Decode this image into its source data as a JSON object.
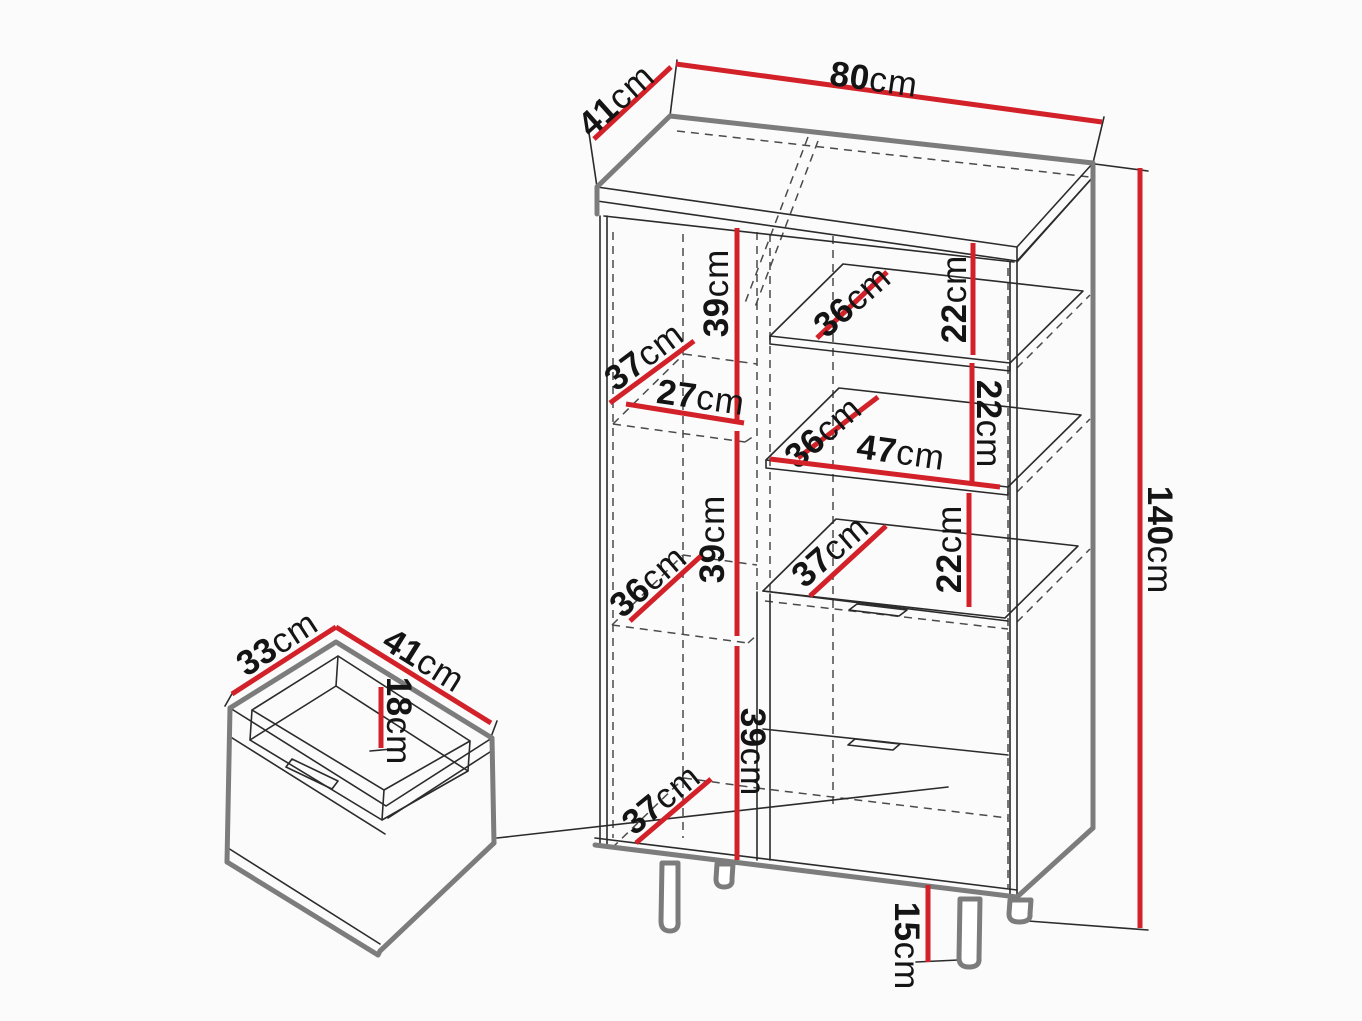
{
  "diagram": {
    "type": "furniture-dimension-diagram",
    "subject": "display cabinet with internal shelves, two drawers and a pulled-out drawer detail",
    "unit": "cm",
    "background": "#fbfbfb",
    "colors": {
      "dimension_line": "#d22129",
      "thick_outline": "#7c7c7c",
      "thin_outline": "#2b2b2b",
      "hidden_line": "#4a4a4a",
      "label": "#141414"
    },
    "overall_dimensions": {
      "width_cm": 80,
      "depth_cm": 41,
      "height_cm": 140,
      "leg_height_cm": 15
    },
    "drawer_dimensions": {
      "width_cm": 41,
      "depth_cm": 33,
      "inner_height_cm": 18
    }
  },
  "dimensions": [
    {
      "id": "top-depth",
      "value": 41,
      "unit": "cm",
      "x": 616,
      "y": 100,
      "rot": -42,
      "line": [
        594,
        139,
        671,
        67
      ]
    },
    {
      "id": "top-width",
      "value": 80,
      "unit": "cm",
      "x": 874,
      "y": 79,
      "rot": 8,
      "line": [
        676,
        64,
        1102,
        122
      ]
    },
    {
      "id": "overall-height",
      "value": 140,
      "unit": "cm",
      "x": 1160,
      "y": 540,
      "rot": 90,
      "line": [
        1140,
        168,
        1140,
        928
      ]
    },
    {
      "id": "left-section1-height",
      "value": 39,
      "unit": "cm",
      "x": 716,
      "y": 293,
      "rot": -90,
      "line": [
        737,
        228,
        737,
        420
      ]
    },
    {
      "id": "left-shelf1-depth",
      "value": 37,
      "unit": "cm",
      "x": 644,
      "y": 356,
      "rot": -37,
      "line": [
        610,
        403,
        694,
        341
      ]
    },
    {
      "id": "left-inner-width",
      "value": 27,
      "unit": "cm",
      "x": 701,
      "y": 397,
      "rot": 8,
      "line": [
        626,
        404,
        744,
        423
      ]
    },
    {
      "id": "right-shelf1-depth",
      "value": 36,
      "unit": "cm",
      "x": 852,
      "y": 301,
      "rot": -41,
      "line": [
        817,
        338,
        887,
        272
      ]
    },
    {
      "id": "right-gap1-height",
      "value": 22,
      "unit": "cm",
      "x": 954,
      "y": 299,
      "rot": -90,
      "line": [
        973,
        243,
        973,
        355
      ]
    },
    {
      "id": "right-shelf2-depth",
      "value": 36,
      "unit": "cm",
      "x": 823,
      "y": 432,
      "rot": -41,
      "line": [
        798,
        458,
        878,
        397
      ]
    },
    {
      "id": "right-inner-width",
      "value": 47,
      "unit": "cm",
      "x": 901,
      "y": 452,
      "rot": 8,
      "line": [
        770,
        459,
        1000,
        487
      ]
    },
    {
      "id": "right-gap2-height",
      "value": 22,
      "unit": "cm",
      "x": 989,
      "y": 424,
      "rot": 90,
      "line": [
        972,
        363,
        972,
        485
      ]
    },
    {
      "id": "left-section2-height",
      "value": 39,
      "unit": "cm",
      "x": 712,
      "y": 539,
      "rot": -90,
      "line": [
        737,
        431,
        737,
        636
      ]
    },
    {
      "id": "left-shelf2-depth",
      "value": 36,
      "unit": "cm",
      "x": 648,
      "y": 581,
      "rot": -41,
      "line": [
        630,
        621,
        701,
        556
      ]
    },
    {
      "id": "right-shelf3-depth",
      "value": 37,
      "unit": "cm",
      "x": 830,
      "y": 551,
      "rot": -41,
      "line": [
        810,
        596,
        886,
        526
      ]
    },
    {
      "id": "right-gap3-height",
      "value": 22,
      "unit": "cm",
      "x": 949,
      "y": 549,
      "rot": -90,
      "line": [
        969,
        493,
        969,
        607
      ]
    },
    {
      "id": "left-section3-height",
      "value": 39,
      "unit": "cm",
      "x": 753,
      "y": 752,
      "rot": 90,
      "line": [
        737,
        646,
        737,
        860
      ]
    },
    {
      "id": "left-bottom-depth",
      "value": 37,
      "unit": "cm",
      "x": 661,
      "y": 799,
      "rot": -39,
      "line": [
        636,
        843,
        711,
        779
      ]
    },
    {
      "id": "leg-height",
      "value": 15,
      "unit": "cm",
      "x": 907,
      "y": 946,
      "rot": 90,
      "line": [
        928,
        885,
        928,
        962
      ]
    },
    {
      "id": "drawer-depth",
      "value": 33,
      "unit": "cm",
      "x": 277,
      "y": 643,
      "rot": -33,
      "line": [
        232,
        694,
        336,
        627
      ]
    },
    {
      "id": "drawer-width",
      "value": 41,
      "unit": "cm",
      "x": 424,
      "y": 660,
      "rot": 32,
      "line": [
        336,
        627,
        491,
        723
      ]
    },
    {
      "id": "drawer-inner-height",
      "value": 18,
      "unit": "cm",
      "x": 399,
      "y": 721,
      "rot": 90,
      "line": [
        381,
        687,
        381,
        748
      ]
    }
  ]
}
